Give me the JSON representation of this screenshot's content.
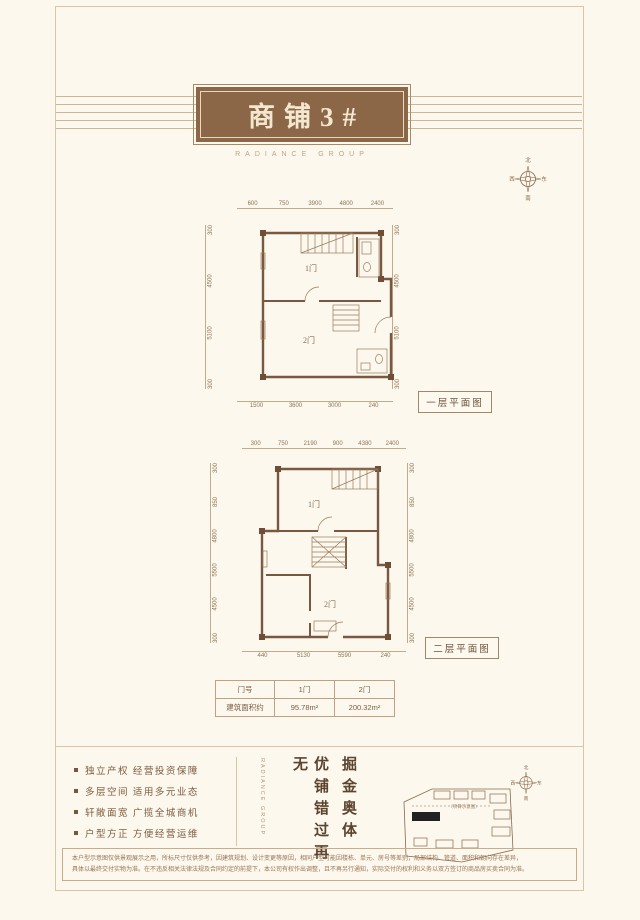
{
  "page": {
    "title": "商铺3#",
    "subtitle": "RADIANCE GROUP"
  },
  "compass": {
    "north": "北",
    "south": "南",
    "west": "西",
    "east": "东"
  },
  "plan1": {
    "label": "一层平面图",
    "rooms": [
      "1门",
      "2门"
    ],
    "dims_top": [
      "600",
      "750",
      "3900",
      "4800",
      "2400"
    ],
    "dims_left": [
      "300",
      "4500",
      "5100",
      "300"
    ],
    "dims_right": [
      "300",
      "4500",
      "5100",
      "300"
    ],
    "dims_bottom": [
      "1500",
      "3600",
      "3000",
      "240"
    ]
  },
  "plan2": {
    "label": "二层平面图",
    "rooms": [
      "1门",
      "2门"
    ],
    "dims_top": [
      "300",
      "750",
      "2190",
      "900",
      "4380",
      "2400"
    ],
    "dims_left": [
      "300",
      "850",
      "4800",
      "5500",
      "4500",
      "300"
    ],
    "dims_right": [
      "300",
      "850",
      "4800",
      "5500",
      "4500",
      "300"
    ],
    "dims_bottom": [
      "440",
      "5130",
      "5590",
      "240"
    ]
  },
  "table": {
    "rows": [
      [
        "门号",
        "1门",
        "2门"
      ],
      [
        "建筑面积约",
        "95.78m²",
        "200.32m²"
      ]
    ]
  },
  "features": [
    "独立产权 经营投资保障",
    "多层空间 适用多元业态",
    "轩敞面宽 广揽全城商机",
    "户型方正 方便经营运维"
  ],
  "slogan": {
    "line1": "掘金奥体",
    "line2": "优铺错过再无",
    "brand": "RADIANCE GROUP"
  },
  "site_plan": {
    "note": "（项目示意图）"
  },
  "disclaimer": {
    "line1": "本户型示意图仅供景观展示之用，所标尺寸仅供参考，因建筑规划、设计变更等原因，相同户型可能因楼栋、单元、房号等差别，局部结构、管道、面积和朝向存在差异，",
    "line2": "具体以最终交付实物为准。在不违反相关法律法规及合同约定的前提下，本公司有权作出调整，且不再另行通知，实际交付的权利和义务以双方签订的商品房买卖合同为准。"
  }
}
